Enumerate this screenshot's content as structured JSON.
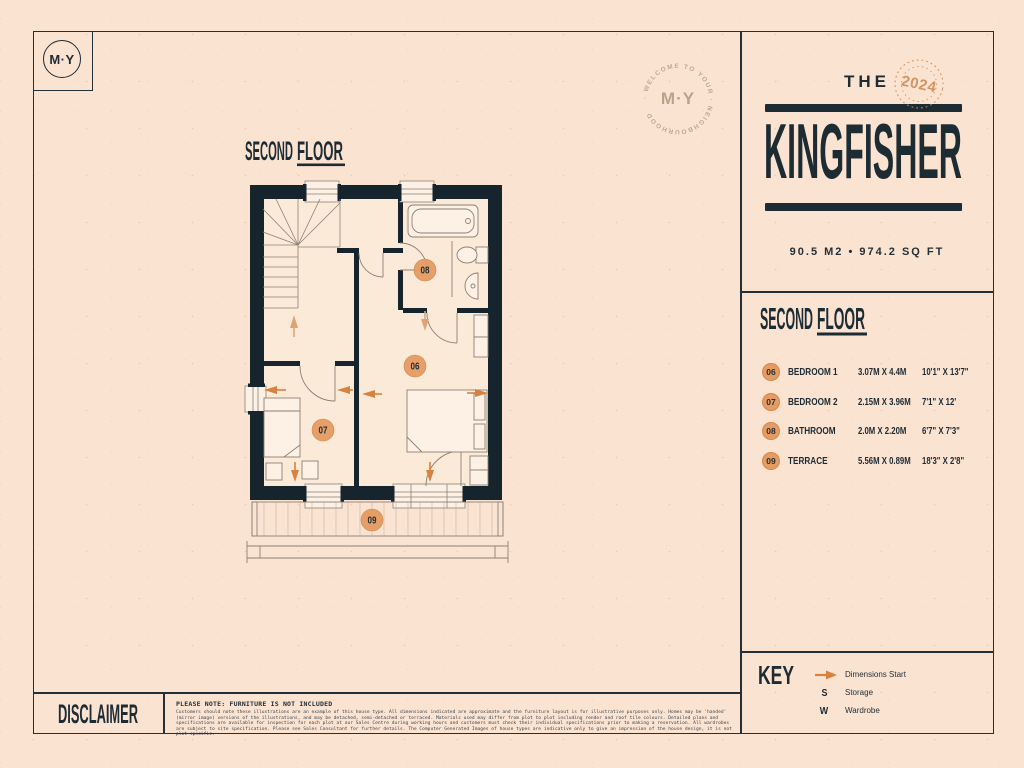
{
  "colors": {
    "background": "#fbe3d2",
    "ink": "#1d2b33",
    "wall": "#16242d",
    "accent_orange": "#d9813f",
    "badge_orange": "#e59b62",
    "stamp_orange": "#cf8a52",
    "tan": "#bda891",
    "plan_line": "#8b8175"
  },
  "logo": {
    "text": "M·Y"
  },
  "welcome_badge": {
    "ring_text": "· WELCOME TO YOUR · NEIGHBOURHOOD",
    "center_text": "M·Y"
  },
  "title_block": {
    "pre": "THE",
    "name": "KINGFISHER",
    "stamp_year": "2024",
    "area": "90.5 M2 • 974.2 SQ FT"
  },
  "plan": {
    "heading": {
      "word1": "SECOND",
      "word2": "FLOOR"
    },
    "badges": {
      "bedroom1": "06",
      "bedroom2": "07",
      "bathroom": "08",
      "terrace": "09"
    }
  },
  "panel": {
    "heading": {
      "word1": "SECOND",
      "word2": "FLOOR"
    },
    "rooms": [
      {
        "num": "06",
        "name": "BEDROOM 1",
        "metric": "3.07M X 4.4M",
        "imperial": "10'1\" X 13'7\""
      },
      {
        "num": "07",
        "name": "BEDROOM 2",
        "metric": "2.15M X 3.96M",
        "imperial": "7'1\" X 12'"
      },
      {
        "num": "08",
        "name": "BATHROOM",
        "metric": "2.0M X 2.20M",
        "imperial": "6'7\" X 7'3\""
      },
      {
        "num": "09",
        "name": "TERRACE",
        "metric": "5.56M X 0.89M",
        "imperial": "18'3\" X 2'8\""
      }
    ]
  },
  "key": {
    "title": "KEY",
    "items": [
      {
        "symbol": "dimensions-arrow",
        "label": "Dimensions Start"
      },
      {
        "symbol": "S",
        "label": "Storage"
      },
      {
        "symbol": "W",
        "label": "Wardrobe"
      }
    ]
  },
  "disclaimer": {
    "title": "DISCLAIMER",
    "note": "PLEASE NOTE: FURNITURE IS NOT INCLUDED",
    "body": "Customers should note these illustrations are an example of this house type. All dimensions indicated are approximate and the furniture layout is for illustrative purposes only. Homes may be 'handed' (mirror image) versions of the illustrations, and may be detached, semi-detached or terraced. Materials used may differ from plot to plot including render and roof tile colours. Detailed plans and specifications are available for inspection for each plot at our Sales Centre during working hours and customers must check their individual specifications prior to making a reservation. All wardrobes are subject to site specification. Please see Sales Consultant for further details. The Computer Generated Images of house types are indicative only to give an impression of the house design, it is not plot specific."
  }
}
